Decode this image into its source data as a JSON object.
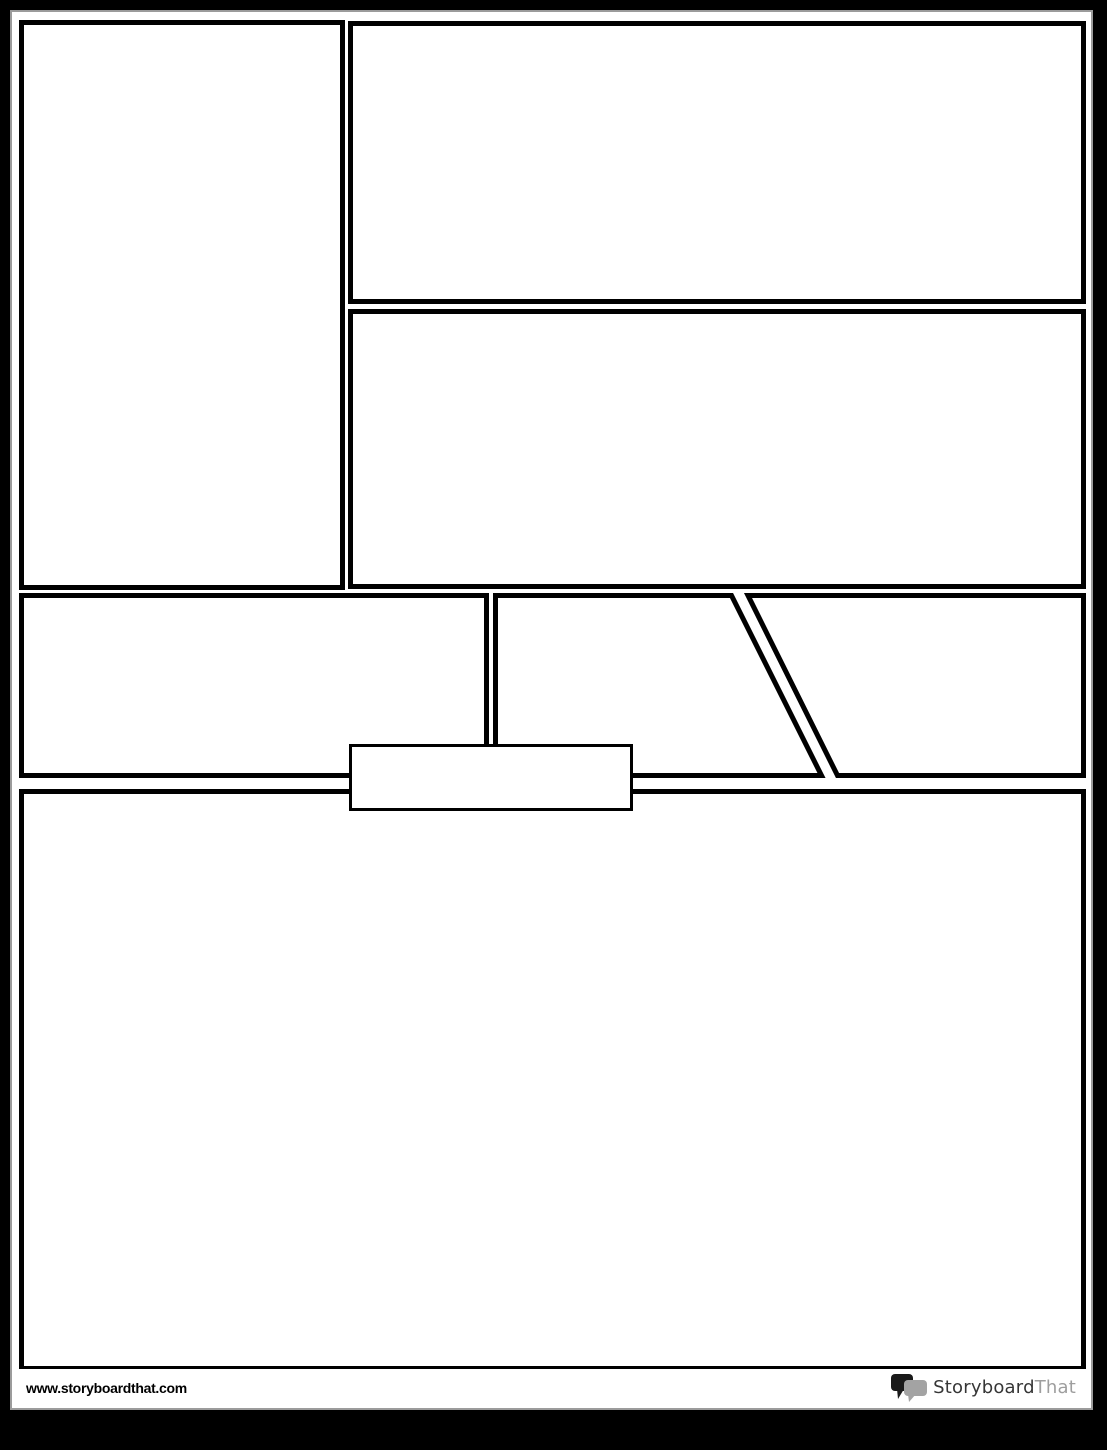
{
  "document": {
    "type": "comic-book-layout-template",
    "page_background": "#ffffff",
    "margin_background": "#000000",
    "panel_border_color": "#000000",
    "page_edge_color": "#9b9b9b"
  },
  "panels": [
    {
      "id": "panel-1",
      "shape": "rectangle",
      "position": "left-column-tall",
      "content": ""
    },
    {
      "id": "panel-2",
      "shape": "rectangle",
      "position": "top-right-wide",
      "content": ""
    },
    {
      "id": "panel-3",
      "shape": "rectangle",
      "position": "middle-right-wide",
      "content": ""
    },
    {
      "id": "panel-4",
      "shape": "rectangle",
      "position": "third-row-left",
      "content": ""
    },
    {
      "id": "panel-5",
      "shape": "quadrilateral-right-edge-slanted",
      "position": "third-row-middle",
      "content": ""
    },
    {
      "id": "panel-6",
      "shape": "quadrilateral-left-edge-slanted",
      "position": "third-row-right",
      "content": ""
    },
    {
      "id": "panel-7",
      "shape": "rectangle",
      "position": "bottom-full-width",
      "content": ""
    },
    {
      "id": "caption-box",
      "shape": "rectangle",
      "position": "overlapping-third-row-bottom-center-left",
      "content": ""
    }
  ],
  "footer": {
    "url": "www.storyboardthat.com",
    "logo": {
      "icon": "speech-bubbles-icon",
      "text_primary": "Storyboard",
      "text_secondary": "That",
      "color_primary": "#363636",
      "color_secondary": "#9e9e9e",
      "bubble_dark": "#1a1a1a",
      "bubble_light": "#a3a3a3"
    }
  }
}
